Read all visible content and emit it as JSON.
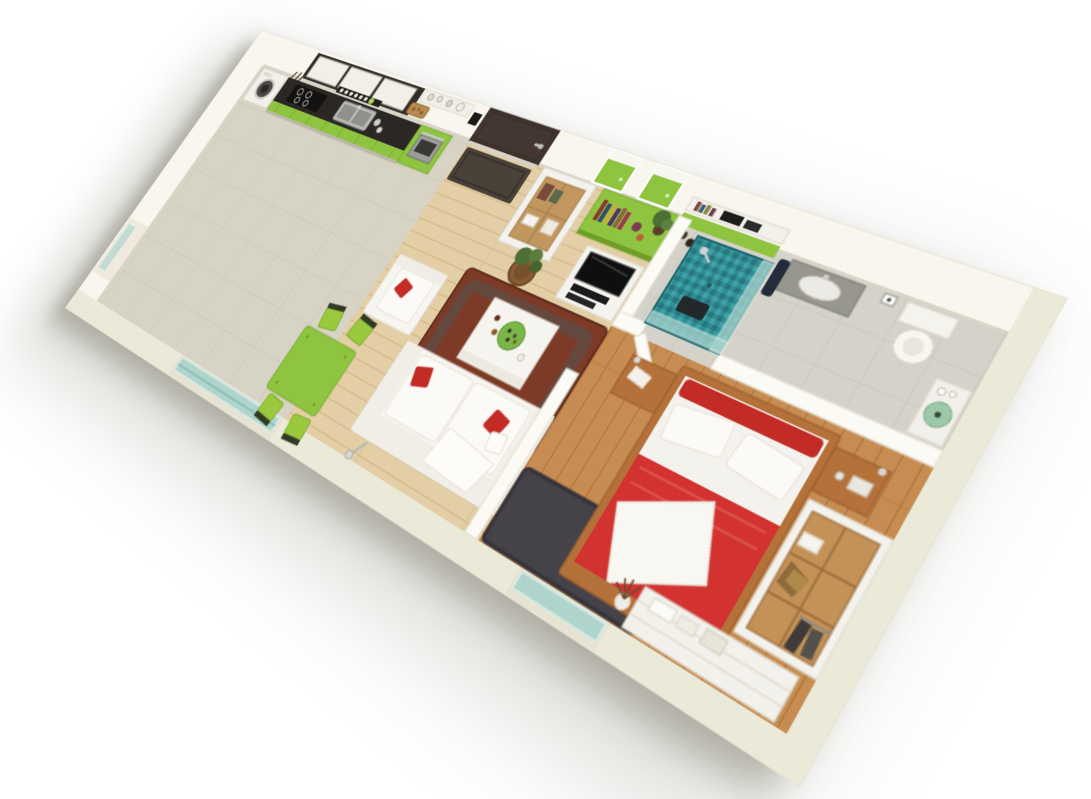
{
  "scene": {
    "type": "3d-isometric-floor-plan-render",
    "subject": "one-bedroom apartment",
    "background": "plain white",
    "view": "cutaway axonometric from above, rotated clockwise"
  },
  "rooms": [
    {
      "name": "kitchen",
      "floor": "beige ceramic tile",
      "items": [
        "washing-machine",
        "green-base-cabinets",
        "dark-countertop",
        "induction-cooktop",
        "stainless-sink",
        "dish-rack",
        "built-in-oven-in-green-tall-unit",
        "upper-cabinets-dark-frame-white-doors",
        "wall-shelf-with-dishes",
        "bread-basket",
        "hanging-utensils"
      ]
    },
    {
      "name": "entry",
      "items": [
        "dark-brown-entry-door",
        "silver-door-handle",
        "dark-doormat",
        "wall-intercom",
        "white-storage-cabinet-wood-interior-with-books",
        "floor-plant-in-wicker-basket"
      ]
    },
    {
      "name": "living-dining",
      "floor": "light oak planks",
      "items": [
        "green-square-dining-table",
        "four-green-chairs",
        "white-armchair-with-red-pillow",
        "white-sofa-with-red-pillows-and-throw",
        "white-coffee-table-with-green-platter-and-bottles",
        "dark-red-shag-rug",
        "tv-on-white-media-stand-with-hifi",
        "green-sideboard-bench-with-books-vases-plant",
        "green-white-wall-cubes",
        "wall-shelves-with-books-and-audio",
        "floor-lamp",
        "balcony-sliding-glass-door",
        "side-window-in-left-wall"
      ]
    },
    {
      "name": "bathroom",
      "floor": "grey tile",
      "items": [
        "teal-mosaic-shower-with-glass-screen",
        "shower-seat",
        "grey-wall-hung-vanity-with-white-sink",
        "navy-towel",
        "toilet",
        "toilet-paper-holder",
        "green-glass-bowl-washbasin-with-bottles",
        "open-white-bathroom-door"
      ]
    },
    {
      "name": "bedroom",
      "floor": "warm oak planks",
      "items": [
        "double-bed-red-blanket-white-duvet",
        "red-headboard-cushions",
        "two-white-pillows",
        "white-throw-at-foot",
        "wooden-floating-nightstands",
        "reading-lamps",
        "coffee-cup",
        "magazines",
        "charcoal-shag-rug",
        "built-in-wardrobe-with-shelves-and-hanging-clothes",
        "white-dresser-with-folded-linens-and-boxes",
        "vase-with-dry-branches",
        "glass-balcony-door"
      ]
    }
  ],
  "palette": {
    "background": "#ffffff",
    "wall_top": "#f6f4ea",
    "wall_face": "#fbfaf5",
    "wall_cut": "#ebe9d8",
    "wall_shadow_line": "#d9d6c7",
    "tile_floor": "#d8d4c5",
    "tile_line": "#c9c5b4",
    "wood_living": "#e3cea5",
    "wood_living_line": "#d3b98c",
    "wood_bedroom": "#c68c51",
    "wood_bedroom_line": "#b0763c",
    "bath_floor": "#d5d2c9",
    "accent_green": "#8fc441",
    "green_dark": "#76a82c",
    "counter_dark": "#2b2725",
    "cabinet_white": "#f1efe8",
    "door_brown": "#443630",
    "sofa_white": "#f7f5f0",
    "red_accent": "#c32b26",
    "red_bed": "#d23330",
    "rug_red": "#7d3a27",
    "rug_red_dark": "#5f4e46",
    "rug_charcoal": "#45424a",
    "shower_teal": "#2f8d93",
    "glass_teal": "#a9d3cc",
    "metal": "#b9b8b2",
    "wood_furniture": "#b5713a",
    "closet_wood": "#c49256",
    "plant_green": "#4d6e35",
    "basket_brown": "#8a5c33"
  }
}
